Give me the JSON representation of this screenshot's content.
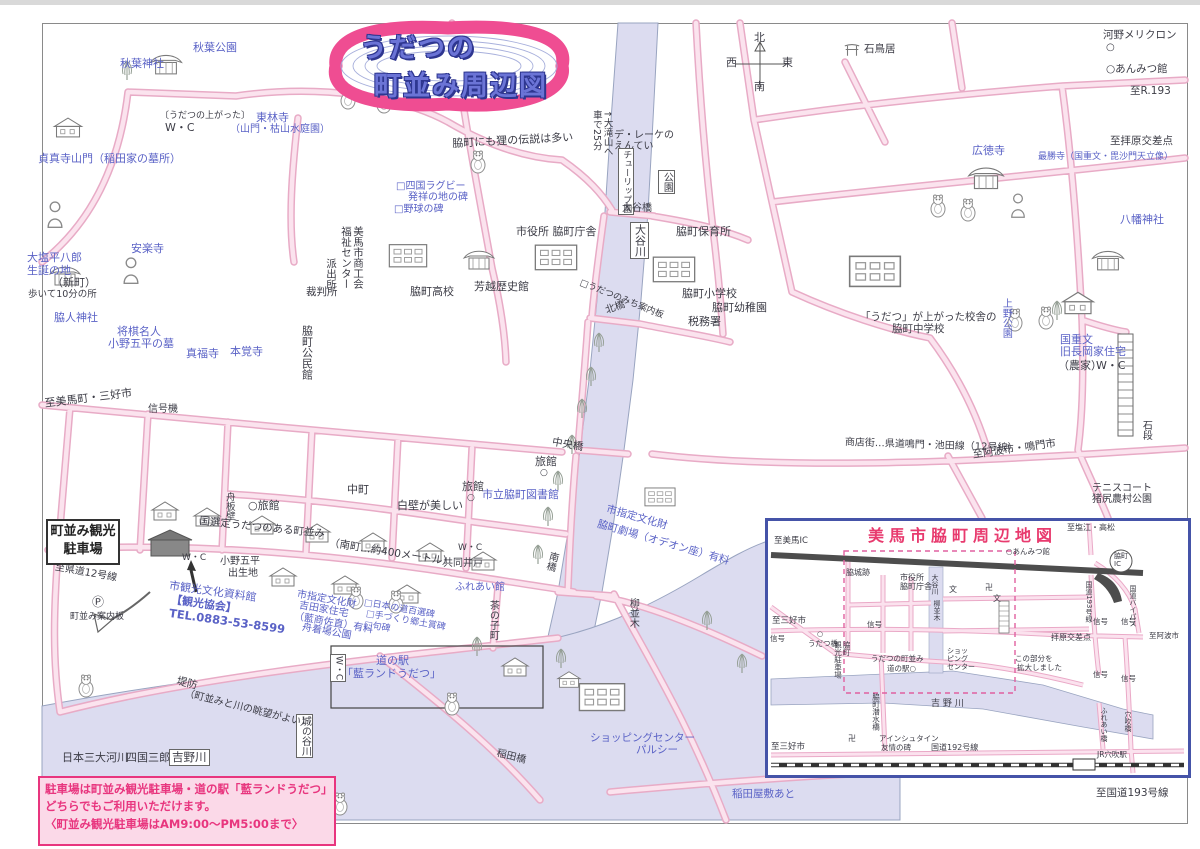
{
  "title_badge": {
    "line1": "うだつの",
    "line2": "町並み周辺図"
  },
  "parking_box": {
    "line1": "町並み観光",
    "line2": "駐車場"
  },
  "note_box": {
    "line1": "駐車場は町並み観光駐車場・道の駅「藍ランドうだつ」",
    "line2": "どちらでもご利用いただけます。",
    "line3": "〈町並み観光駐車場はAM9:00〜PM5:00まで〉"
  },
  "colors": {
    "badge_border": "#ef4d92",
    "badge_text": "#6b74d6",
    "label_blue": "#5a62c6",
    "label_black": "#3c3c46",
    "road_edge": "#e8abc6",
    "road_fill": "#fbe3ee",
    "river": "#dcdcf0",
    "note_pink": "#fbd9e8",
    "magenta": "#e8357e",
    "inset_border": "#4553a8",
    "inset_title": "#e83a6e"
  },
  "map": {
    "labels": [
      {
        "t": "秋葉公園",
        "x": 193,
        "y": 42,
        "c": "b"
      },
      {
        "t": "秋葉神社",
        "x": 120,
        "y": 58,
        "c": "b"
      },
      {
        "t": "〔うだつの上がった〕",
        "x": 160,
        "y": 111,
        "s": 9
      },
      {
        "t": "W・C",
        "x": 165,
        "y": 122
      },
      {
        "t": "東林寺",
        "x": 256,
        "y": 112,
        "c": "b"
      },
      {
        "t": "（山門・枯山水庭園）",
        "x": 230,
        "y": 124,
        "c": "b",
        "s": 10
      },
      {
        "t": "貞真寺山門（稲田家の墓所）",
        "x": 38,
        "y": 153,
        "c": "b"
      },
      {
        "t": "大塩平八郎",
        "x": 27,
        "y": 252,
        "c": "b"
      },
      {
        "t": "生誕の地",
        "x": 27,
        "y": 265,
        "c": "b"
      },
      {
        "t": "（新町）",
        "x": 52,
        "y": 277
      },
      {
        "t": "歩いて10分の所",
        "x": 28,
        "y": 290,
        "s": 9.5
      },
      {
        "t": "安楽寺",
        "x": 131,
        "y": 243,
        "c": "b"
      },
      {
        "t": "将棋名人",
        "x": 117,
        "y": 326,
        "c": "b"
      },
      {
        "t": "小野五平の墓",
        "x": 108,
        "y": 338,
        "c": "b"
      },
      {
        "t": "脇人神社",
        "x": 54,
        "y": 312,
        "c": "b"
      },
      {
        "t": "真福寺",
        "x": 186,
        "y": 348,
        "c": "b"
      },
      {
        "t": "本覚寺",
        "x": 230,
        "y": 346,
        "c": "b"
      },
      {
        "t": "脇町公民館",
        "x": 300,
        "y": 325,
        "v": 1
      },
      {
        "t": "至美馬町・三好市",
        "x": 44,
        "y": 398,
        "r": -7
      },
      {
        "t": "信号機",
        "x": 148,
        "y": 404,
        "s": 10
      },
      {
        "t": "美馬市商工会\n福祉センター",
        "x": 339,
        "y": 226,
        "v": 1,
        "s": 10.5
      },
      {
        "t": "派出所",
        "x": 324,
        "y": 258,
        "v": 1,
        "s": 10.5
      },
      {
        "t": "裁判所",
        "x": 306,
        "y": 287,
        "s": 10.5
      },
      {
        "t": "脇町高校",
        "x": 410,
        "y": 286
      },
      {
        "t": "芳越歴史館",
        "x": 474,
        "y": 281
      },
      {
        "t": "市役所 脇町庁舎",
        "x": 516,
        "y": 226
      },
      {
        "t": "□四国ラグビー",
        "x": 396,
        "y": 181,
        "c": "b",
        "s": 10
      },
      {
        "t": "発祥の地の碑",
        "x": 408,
        "y": 192,
        "c": "b",
        "s": 10
      },
      {
        "t": "□野球の碑",
        "x": 394,
        "y": 204,
        "c": "b",
        "s": 10
      },
      {
        "t": "脇町にも狸の伝説は多い",
        "x": 452,
        "y": 138,
        "r": -3
      },
      {
        "t": "デ・レーケの\nえんてい",
        "x": 614,
        "y": 130,
        "s": 10
      },
      {
        "t": "チューリップ園",
        "x": 618,
        "y": 148,
        "v": 1,
        "s": 9,
        "box": 1
      },
      {
        "t": "公園",
        "x": 658,
        "y": 170,
        "v": 1,
        "s": 10,
        "box": 1
      },
      {
        "t": "大谷橋",
        "x": 622,
        "y": 203,
        "s": 10
      },
      {
        "t": "大谷川",
        "x": 630,
        "y": 222,
        "v": 1,
        "s": 11,
        "box": 1
      },
      {
        "t": "↑大滝山へ\n車で25分",
        "x": 590,
        "y": 110,
        "v": 1,
        "s": 9.5
      },
      {
        "t": "北",
        "x": 754,
        "y": 32
      },
      {
        "t": "西",
        "x": 726,
        "y": 57
      },
      {
        "t": "東",
        "x": 782,
        "y": 57
      },
      {
        "t": "南",
        "x": 754,
        "y": 81
      },
      {
        "t": "石鳥居",
        "x": 864,
        "y": 44,
        "s": 10.5
      },
      {
        "t": "河野メリクロン",
        "x": 1103,
        "y": 30,
        "s": 10.5
      },
      {
        "t": "○",
        "x": 1106,
        "y": 42,
        "s": 10
      },
      {
        "t": "○あんみつ館",
        "x": 1106,
        "y": 64,
        "s": 10.5
      },
      {
        "t": "至R.193",
        "x": 1130,
        "y": 86,
        "s": 10.5
      },
      {
        "t": "至拝原交差点",
        "x": 1110,
        "y": 136,
        "s": 10.5
      },
      {
        "t": "広徳寺",
        "x": 972,
        "y": 145,
        "c": "b"
      },
      {
        "t": "最勝寺（国重文・毘沙門天立像）",
        "x": 1038,
        "y": 152,
        "c": "b",
        "s": 9
      },
      {
        "t": "八幡神社",
        "x": 1120,
        "y": 214,
        "c": "b"
      },
      {
        "t": "「うだつ」が上がった校舎の",
        "x": 860,
        "y": 312,
        "s": 10.5
      },
      {
        "t": "脇町中学校",
        "x": 892,
        "y": 324,
        "s": 10.5
      },
      {
        "t": "上野公園",
        "x": 1000,
        "y": 298,
        "c": "b",
        "v": 1,
        "s": 10
      },
      {
        "t": "国重文",
        "x": 1060,
        "y": 334,
        "c": "b"
      },
      {
        "t": "旧長岡家住宅",
        "x": 1060,
        "y": 346,
        "c": "b"
      },
      {
        "t": "（農家）",
        "x": 1058,
        "y": 360
      },
      {
        "t": "W・C",
        "x": 1096,
        "y": 360
      },
      {
        "t": "石段",
        "x": 1140,
        "y": 420,
        "v": 1,
        "s": 10
      },
      {
        "t": "商店街…県道鳴門・池田線（12号線）",
        "x": 845,
        "y": 437,
        "s": 10,
        "r": 2
      },
      {
        "t": "至阿波市・鳴門市",
        "x": 972,
        "y": 450,
        "r": -8,
        "s": 10.5
      },
      {
        "t": "テニスコート",
        "x": 1092,
        "y": 483,
        "s": 10
      },
      {
        "t": "猪尻農村公園",
        "x": 1092,
        "y": 494,
        "s": 10
      },
      {
        "t": "脇町保育所",
        "x": 676,
        "y": 226
      },
      {
        "t": "脇町小学校",
        "x": 682,
        "y": 288
      },
      {
        "t": "脇町幼稚園",
        "x": 712,
        "y": 302
      },
      {
        "t": "税務署",
        "x": 688,
        "y": 316
      },
      {
        "t": "北橋",
        "x": 604,
        "y": 306,
        "r": -20,
        "s": 10
      },
      {
        "t": "□うだつのみち案内板",
        "x": 582,
        "y": 278,
        "r": 22,
        "s": 9
      },
      {
        "t": "中央橋",
        "x": 553,
        "y": 437,
        "r": 10,
        "s": 10.5
      },
      {
        "t": "旅館",
        "x": 535,
        "y": 456
      },
      {
        "t": "○",
        "x": 540,
        "y": 468,
        "s": 9
      },
      {
        "t": "旅館",
        "x": 462,
        "y": 481
      },
      {
        "t": "○",
        "x": 467,
        "y": 493,
        "s": 9
      },
      {
        "t": "○旅館",
        "x": 248,
        "y": 500
      },
      {
        "t": "市立脇町図書館",
        "x": 482,
        "y": 489,
        "c": "b"
      },
      {
        "t": "中町",
        "x": 347,
        "y": 484
      },
      {
        "t": "白壁が美しい",
        "x": 397,
        "y": 500
      },
      {
        "t": "市指定文化財",
        "x": 608,
        "y": 504,
        "c": "b",
        "r": 16,
        "s": 10.5
      },
      {
        "t": "脇町劇場（オデオン座）有料",
        "x": 599,
        "y": 519,
        "c": "b",
        "r": 16,
        "s": 10.5
      },
      {
        "t": "南橋",
        "x": 548,
        "y": 550,
        "v": 1,
        "r": 15,
        "s": 10
      },
      {
        "t": "共同井戸",
        "x": 443,
        "y": 558,
        "s": 10
      },
      {
        "t": "ふれあい館",
        "x": 455,
        "y": 582,
        "c": "b",
        "s": 10
      },
      {
        "t": "茶の子町",
        "x": 487,
        "y": 600,
        "v": 1,
        "s": 10
      },
      {
        "t": "柳並木",
        "x": 627,
        "y": 598,
        "v": 1,
        "s": 10
      },
      {
        "t": "国選定うだつのある町並み",
        "x": 200,
        "y": 516,
        "r": 6,
        "s": 10.5
      },
      {
        "t": "（南町…約400メートル）",
        "x": 330,
        "y": 538,
        "r": 9,
        "s": 10.5
      },
      {
        "t": "小野五平",
        "x": 220,
        "y": 556,
        "s": 10
      },
      {
        "t": "出生地",
        "x": 228,
        "y": 568,
        "s": 10
      },
      {
        "t": "W・C",
        "x": 182,
        "y": 553,
        "s": 9
      },
      {
        "t": "市観光文化資料館",
        "x": 170,
        "y": 580,
        "c": "b",
        "r": 8
      },
      {
        "t": "【観光協会】",
        "x": 172,
        "y": 594,
        "c": "b",
        "r": 8,
        "w": 1
      },
      {
        "t": "TEL.0883-53-8599",
        "x": 170,
        "y": 607,
        "c": "b",
        "r": 8,
        "s": 11.5,
        "w": 1
      },
      {
        "t": "至県道12号線",
        "x": 56,
        "y": 562,
        "r": 10,
        "s": 10
      },
      {
        "t": "Ⓟ",
        "x": 92,
        "y": 596,
        "s": 12
      },
      {
        "t": "町並み案内板",
        "x": 70,
        "y": 612,
        "s": 9
      },
      {
        "t": "市指定文化財",
        "x": 298,
        "y": 589,
        "c": "b",
        "r": 10,
        "s": 10
      },
      {
        "t": "吉田家住宅",
        "x": 300,
        "y": 600,
        "c": "b",
        "r": 10,
        "s": 10
      },
      {
        "t": "（藍商佐直）有料",
        "x": 295,
        "y": 611,
        "c": "b",
        "r": 10,
        "s": 10
      },
      {
        "t": "舟着場公園",
        "x": 303,
        "y": 622,
        "c": "b",
        "r": 10,
        "s": 10
      },
      {
        "t": "□日本の道百選碑",
        "x": 365,
        "y": 598,
        "c": "b",
        "r": 10,
        "s": 9
      },
      {
        "t": "□手づくり郷土賞碑",
        "x": 367,
        "y": 609,
        "c": "b",
        "r": 10,
        "s": 9
      },
      {
        "t": "□句碑",
        "x": 365,
        "y": 620,
        "c": "b",
        "r": 10,
        "s": 9
      },
      {
        "t": "舟板壁",
        "x": 223,
        "y": 492,
        "v": 1,
        "s": 9.5
      },
      {
        "t": "W・C",
        "x": 458,
        "y": 543,
        "s": 9
      },
      {
        "t": "W・C",
        "x": 330,
        "y": 654,
        "v": 1,
        "box": 1,
        "s": 9
      },
      {
        "t": "道の駅",
        "x": 376,
        "y": 655,
        "c": "b"
      },
      {
        "t": "「藍ランドうだつ」",
        "x": 342,
        "y": 668,
        "c": "b"
      },
      {
        "t": "ショッピングセンター",
        "x": 590,
        "y": 733,
        "c": "b",
        "s": 10.5
      },
      {
        "t": "パルシー",
        "x": 636,
        "y": 745,
        "c": "b",
        "s": 10.5
      },
      {
        "t": "城の谷川",
        "x": 296,
        "y": 714,
        "v": 1,
        "s": 10,
        "box": 1
      },
      {
        "t": "稲田橋",
        "x": 498,
        "y": 748,
        "r": 14,
        "s": 10
      },
      {
        "t": "堤防",
        "x": 178,
        "y": 676,
        "r": 14,
        "s": 10.5
      },
      {
        "t": "（町並みと川の眺望がよい）",
        "x": 186,
        "y": 688,
        "r": 14,
        "s": 10
      },
      {
        "t": "日本三大河川",
        "x": 62,
        "y": 752
      },
      {
        "t": "四国三郎",
        "x": 126,
        "y": 752
      },
      {
        "t": "吉野川",
        "x": 169,
        "y": 749,
        "box": 1,
        "s": 11.5
      },
      {
        "t": "稲田屋敷あと",
        "x": 732,
        "y": 789,
        "c": "b",
        "s": 10.5
      },
      {
        "t": "至国道193号線",
        "x": 1096,
        "y": 788,
        "s": 10.5
      }
    ]
  },
  "inset": {
    "title": "美馬市脇町周辺地図",
    "labels": [
      {
        "t": "至美馬IC",
        "x": 6,
        "y": 16,
        "s": 8.5
      },
      {
        "t": "脇城跡",
        "x": 78,
        "y": 47,
        "s": 8
      },
      {
        "t": "市役所\n脇町庁舎",
        "x": 132,
        "y": 52,
        "s": 8
      },
      {
        "t": "大谷川",
        "x": 162,
        "y": 53,
        "v": 1,
        "s": 7
      },
      {
        "t": "文",
        "x": 181,
        "y": 64,
        "s": 8
      },
      {
        "t": "柳並木",
        "x": 164,
        "y": 79,
        "v": 1,
        "s": 7
      },
      {
        "t": "至三好市",
        "x": 4,
        "y": 96,
        "s": 8.5
      },
      {
        "t": "信号",
        "x": 99,
        "y": 100,
        "s": 7.5
      },
      {
        "t": "信号",
        "x": 2,
        "y": 114,
        "s": 7.5
      },
      {
        "t": "○",
        "x": 49,
        "y": 110,
        "s": 7
      },
      {
        "t": "うだつ橋",
        "x": 40,
        "y": 119,
        "s": 7.5
      },
      {
        "t": "脇町\n観光駐車場",
        "x": 65,
        "y": 120,
        "v": 1,
        "s": 7.5
      },
      {
        "t": "うだつの町並み",
        "x": 103,
        "y": 134,
        "s": 7.5
      },
      {
        "t": "道の駅○",
        "x": 119,
        "y": 144,
        "s": 7.5
      },
      {
        "t": "ショッ\nピング\nセンター",
        "x": 179,
        "y": 127,
        "s": 7
      },
      {
        "t": "脇町潜水橋",
        "x": 103,
        "y": 172,
        "v": 1,
        "s": 7.5
      },
      {
        "t": "吉 野 川",
        "x": 163,
        "y": 178,
        "s": 9
      },
      {
        "t": "卍",
        "x": 80,
        "y": 213,
        "s": 8
      },
      {
        "t": "アインシュタイン",
        "x": 111,
        "y": 214,
        "s": 7.5
      },
      {
        "t": "友情の碑",
        "x": 113,
        "y": 223,
        "s": 7.5
      },
      {
        "t": "国道192号線",
        "x": 163,
        "y": 222,
        "s": 8
      },
      {
        "t": "至三好市",
        "x": 3,
        "y": 222,
        "s": 8.5
      },
      {
        "t": "JR穴吹駅",
        "x": 329,
        "y": 230,
        "s": 7.5
      },
      {
        "t": "至塩江・高松",
        "x": 299,
        "y": 2,
        "s": 8
      },
      {
        "t": "○あんみつ館",
        "x": 238,
        "y": 27,
        "s": 7.5
      },
      {
        "t": "脇町\nIC",
        "x": 346,
        "y": 32,
        "s": 7
      },
      {
        "t": "国道193号線",
        "x": 316,
        "y": 60,
        "v": 1,
        "s": 7
      },
      {
        "t": "国道バイパス",
        "x": 360,
        "y": 64,
        "v": 1,
        "s": 7
      },
      {
        "t": "信号",
        "x": 325,
        "y": 97,
        "s": 7.5
      },
      {
        "t": "信号",
        "x": 353,
        "y": 97,
        "s": 7.5
      },
      {
        "t": "拝原交差点",
        "x": 283,
        "y": 112,
        "s": 8
      },
      {
        "t": "至阿波市",
        "x": 381,
        "y": 111,
        "s": 7.5
      },
      {
        "t": "この部分を",
        "x": 247,
        "y": 134,
        "s": 7.5
      },
      {
        "t": "拡大しました",
        "x": 249,
        "y": 143,
        "s": 7.5
      },
      {
        "t": "信号",
        "x": 325,
        "y": 150,
        "s": 7.5
      },
      {
        "t": "信号",
        "x": 353,
        "y": 154,
        "s": 7.5
      },
      {
        "t": "ふれあい橋",
        "x": 331,
        "y": 186,
        "v": 1,
        "s": 7
      },
      {
        "t": "穴吹橋",
        "x": 355,
        "y": 190,
        "v": 1,
        "s": 7
      },
      {
        "t": "卍",
        "x": 217,
        "y": 62,
        "s": 8
      },
      {
        "t": "文",
        "x": 225,
        "y": 73,
        "s": 8
      }
    ]
  }
}
